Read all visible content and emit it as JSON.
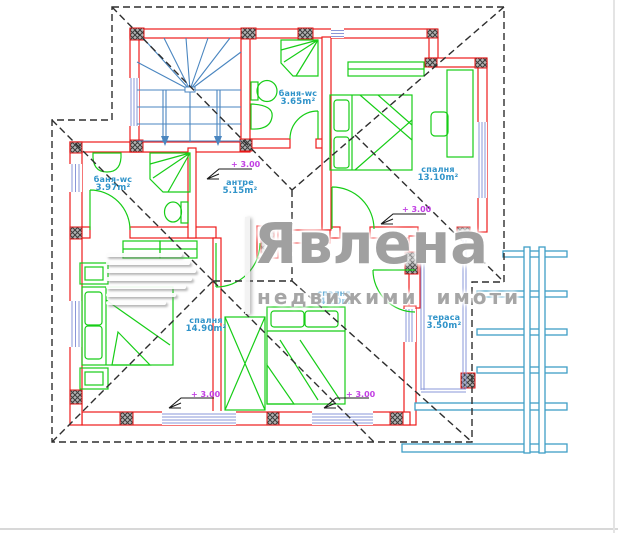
{
  "watermark": {
    "brand": "Явлена",
    "tagline": "недвижими имоти"
  },
  "plan": {
    "rooms": [
      {
        "id": "bath-top",
        "name": "баня-wc",
        "area": "3.65m²"
      },
      {
        "id": "bath-left",
        "name": "баня-wc",
        "area": "3.97m²"
      },
      {
        "id": "hallway",
        "name": "антре",
        "area": "5.15m²"
      },
      {
        "id": "bedroom-right",
        "name": "спалня",
        "area": "13.10m²"
      },
      {
        "id": "bedroom-left",
        "name": "спалня",
        "area": "14.90m²"
      },
      {
        "id": "bedroom-middle",
        "name": "спалня",
        "area": "14.20m²"
      },
      {
        "id": "terrace",
        "name": "тераса",
        "area": "3.50m²"
      }
    ],
    "elevation_label": "+ 3.00",
    "colors": {
      "wall": "#ee1b1b",
      "furniture": "#17cd17",
      "stairs": "#4a86c0",
      "windows": "#8a97d8",
      "pergola": "#3f9fc6",
      "roof_dash": "#2e2e2e",
      "elevation_text": "#c23fe3",
      "room_label": "#2f93c9",
      "watermark_grey": "#969696",
      "column_hatch": "#3c3c3c"
    }
  }
}
